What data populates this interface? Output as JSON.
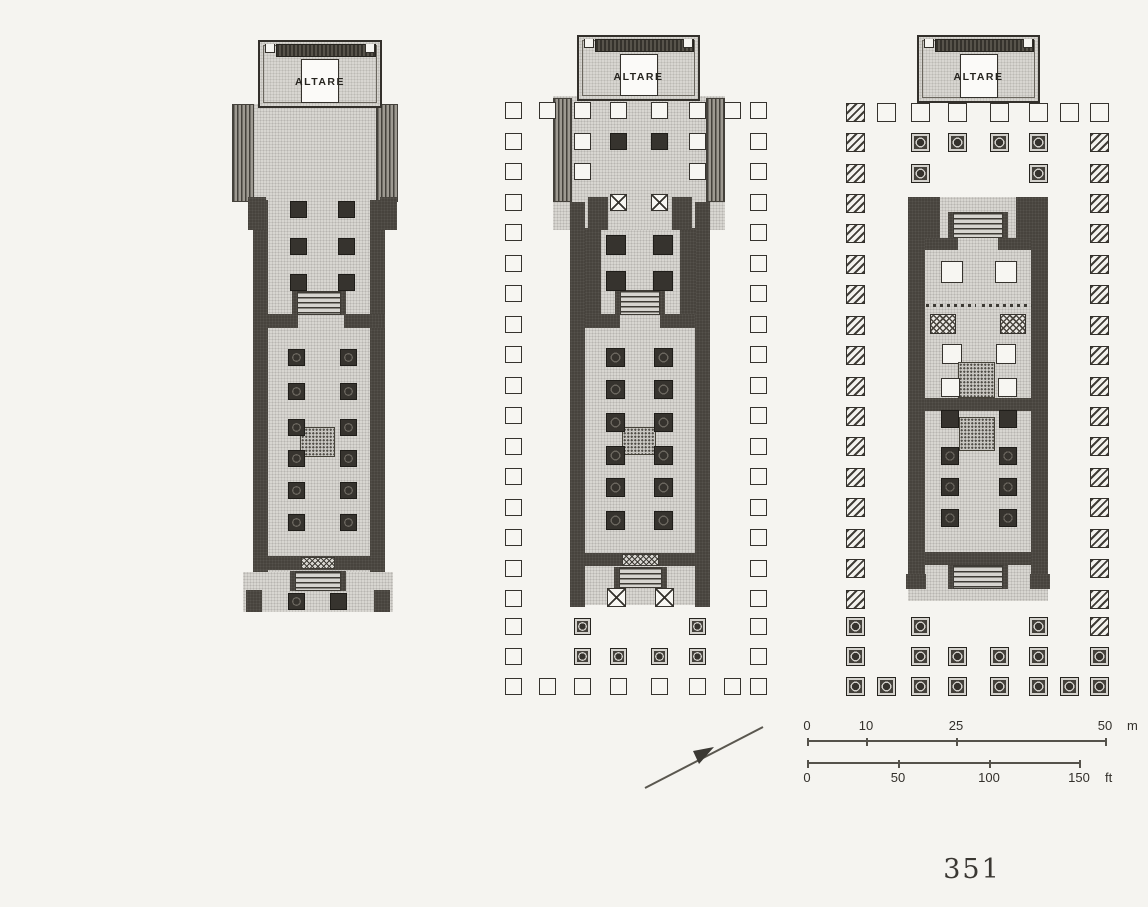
{
  "page": {
    "number": "351"
  },
  "labels": {
    "altar": "ALTARE"
  },
  "colors": {
    "paper": "#f5f4f0",
    "ink": "#33302b",
    "wall": "#47433d",
    "floor": "#d8d6d1"
  },
  "north_arrow": {
    "line": {
      "x1": 645,
      "y1": 788,
      "x2": 763,
      "y2": 727
    },
    "head_points": "714,747 693,751 699,764"
  },
  "scale_bar": {
    "meters": {
      "y": 740,
      "x_start": 807,
      "x_end": 1105,
      "unit": "m",
      "labels_above": true,
      "ticks": [
        [
          "0",
          807
        ],
        [
          "10",
          866
        ],
        [
          "25",
          956
        ],
        [
          "50",
          1105
        ]
      ]
    },
    "feet": {
      "y": 762,
      "x_start": 807,
      "x_end": 1079,
      "unit": "ft",
      "labels_above": false,
      "ticks": [
        [
          "0",
          807
        ],
        [
          "50",
          898
        ],
        [
          "100",
          989
        ],
        [
          "150",
          1079
        ]
      ]
    }
  },
  "plans": [
    {
      "id": "temple-plan-1",
      "altar": {
        "x": 258,
        "y": 40,
        "w": 124,
        "h": 68
      },
      "peristyle": null,
      "elements": [
        [
          "floor",
          232,
          104,
          166,
          98
        ],
        [
          "hatchv",
          232,
          104,
          22,
          98
        ],
        [
          "hatchv",
          376,
          104,
          22,
          98
        ],
        [
          "floor",
          253,
          200,
          132,
          372
        ],
        [
          "floor",
          243,
          572,
          150,
          40
        ],
        [
          "wall",
          253,
          200,
          15,
          372
        ],
        [
          "wall",
          370,
          200,
          15,
          372
        ],
        [
          "wall",
          253,
          556,
          132,
          14
        ],
        [
          "wall",
          253,
          314,
          45,
          14
        ],
        [
          "wall",
          344,
          314,
          41,
          14
        ],
        [
          "wall",
          248,
          197,
          18,
          33
        ],
        [
          "wall",
          380,
          197,
          17,
          33
        ],
        [
          "steps",
          297,
          291,
          44,
          24
        ],
        [
          "wall",
          292,
          291,
          5,
          24
        ],
        [
          "wall",
          341,
          291,
          5,
          24
        ],
        [
          "colD",
          290,
          201,
          17,
          17
        ],
        [
          "colD",
          338,
          201,
          17,
          17
        ],
        [
          "colD",
          290,
          238,
          17,
          17
        ],
        [
          "colD",
          338,
          238,
          17,
          17
        ],
        [
          "colD",
          290,
          274,
          17,
          17
        ],
        [
          "colD",
          338,
          274,
          17,
          17
        ],
        [
          "hearth",
          300,
          427,
          35,
          30
        ],
        [
          "colDC",
          288,
          349,
          17,
          17
        ],
        [
          "colDC",
          340,
          349,
          17,
          17
        ],
        [
          "colDC",
          288,
          383,
          17,
          17
        ],
        [
          "colDC",
          340,
          383,
          17,
          17
        ],
        [
          "colDC",
          288,
          419,
          17,
          17
        ],
        [
          "colDC",
          340,
          419,
          17,
          17
        ],
        [
          "colDC",
          288,
          450,
          17,
          17
        ],
        [
          "colDC",
          340,
          450,
          17,
          17
        ],
        [
          "colDC",
          288,
          482,
          17,
          17
        ],
        [
          "colDC",
          340,
          482,
          17,
          17
        ],
        [
          "colDC",
          288,
          514,
          17,
          17
        ],
        [
          "colDC",
          340,
          514,
          17,
          17
        ],
        [
          "xband",
          301,
          557,
          34,
          12
        ],
        [
          "steps",
          295,
          571,
          46,
          20
        ],
        [
          "wall",
          290,
          571,
          5,
          20
        ],
        [
          "wall",
          341,
          571,
          5,
          20
        ],
        [
          "wall",
          246,
          590,
          16,
          22
        ],
        [
          "wall",
          374,
          590,
          16,
          22
        ],
        [
          "colDC",
          288,
          593,
          17,
          17
        ],
        [
          "colD",
          330,
          593,
          17,
          17
        ]
      ]
    },
    {
      "id": "temple-plan-2",
      "altar": {
        "x": 577,
        "y": 35,
        "w": 123,
        "h": 66
      },
      "peristyle": {
        "cols": [
          505,
          539,
          574,
          610,
          651,
          689,
          724,
          750
        ],
        "rows": [
          102,
          133,
          163,
          194,
          224,
          255,
          285,
          316,
          346,
          377,
          407,
          438,
          468,
          499,
          529,
          560,
          590,
          618,
          648,
          678
        ],
        "size": 17,
        "cells": [
          "OOOOOOOO",
          "O.ODDO.O",
          "O.O..O.O",
          "O..XX..O",
          "O......O",
          "O......O",
          "O......O",
          "O......O",
          "O......O",
          "O......O",
          "O......O",
          "O......O",
          "O......O",
          "O......O",
          "O......O",
          "O......O",
          "O......O",
          "O.C..C.O",
          "O.CCCC.O",
          "OOOOOOOO"
        ]
      },
      "elements": [
        [
          "floor",
          553,
          96,
          172,
          134
        ],
        [
          "hatchv",
          553,
          98,
          19,
          104
        ],
        [
          "hatchv",
          706,
          98,
          19,
          104
        ],
        [
          "floor",
          570,
          230,
          140,
          330
        ],
        [
          "floor",
          580,
          560,
          120,
          45
        ],
        [
          "wall",
          570,
          202,
          15,
          405
        ],
        [
          "wall",
          695,
          202,
          15,
          405
        ],
        [
          "wall",
          585,
          228,
          16,
          86
        ],
        [
          "wall",
          680,
          228,
          16,
          86
        ],
        [
          "wall",
          588,
          197,
          20,
          33
        ],
        [
          "wall",
          672,
          197,
          20,
          33
        ],
        [
          "wall",
          585,
          553,
          110,
          13
        ],
        [
          "wall",
          585,
          314,
          35,
          14
        ],
        [
          "wall",
          660,
          314,
          35,
          14
        ],
        [
          "steps",
          620,
          290,
          40,
          25
        ],
        [
          "wall",
          615,
          290,
          5,
          25
        ],
        [
          "wall",
          660,
          290,
          5,
          25
        ],
        [
          "colD",
          606,
          235,
          20,
          20
        ],
        [
          "colD",
          653,
          235,
          20,
          20
        ],
        [
          "colD",
          606,
          271,
          20,
          20
        ],
        [
          "colD",
          653,
          271,
          20,
          20
        ],
        [
          "hearth",
          622,
          427,
          34,
          28
        ],
        [
          "colDC",
          606,
          348,
          19,
          19
        ],
        [
          "colDC",
          654,
          348,
          19,
          19
        ],
        [
          "colDC",
          606,
          380,
          19,
          19
        ],
        [
          "colDC",
          654,
          380,
          19,
          19
        ],
        [
          "colDC",
          606,
          413,
          19,
          19
        ],
        [
          "colDC",
          654,
          413,
          19,
          19
        ],
        [
          "colDC",
          606,
          446,
          19,
          19
        ],
        [
          "colDC",
          654,
          446,
          19,
          19
        ],
        [
          "colDC",
          606,
          478,
          19,
          19
        ],
        [
          "colDC",
          654,
          478,
          19,
          19
        ],
        [
          "colDC",
          606,
          511,
          19,
          19
        ],
        [
          "colDC",
          654,
          511,
          19,
          19
        ],
        [
          "xband",
          622,
          554,
          37,
          12
        ],
        [
          "steps",
          619,
          567,
          43,
          21
        ],
        [
          "wall",
          614,
          567,
          5,
          21
        ],
        [
          "wall",
          662,
          567,
          5,
          21
        ],
        [
          "colX",
          607,
          588,
          19,
          19
        ],
        [
          "colX",
          655,
          588,
          19,
          19
        ]
      ]
    },
    {
      "id": "temple-plan-3",
      "altar": {
        "x": 917,
        "y": 35,
        "w": 123,
        "h": 68
      },
      "peristyle": {
        "cols": [
          846,
          877,
          911,
          948,
          990,
          1029,
          1060,
          1090
        ],
        "rows": [
          103,
          133,
          164,
          194,
          224,
          255,
          285,
          316,
          346,
          377,
          407,
          437,
          468,
          498,
          529,
          559,
          590,
          617,
          647,
          677
        ],
        "size": 19,
        "cells": [
          "HOOOOOOO",
          "H.CCCC.H",
          "H.C..C.H",
          "H......H",
          "H......H",
          "H......H",
          "H......H",
          "H......H",
          "H......H",
          "H......H",
          "H......H",
          "H......H",
          "H......H",
          "H......H",
          "H......H",
          "H......H",
          "H......H",
          "C.C..C.H",
          "C.CCCC.C",
          "CCCCCCCC"
        ]
      },
      "elements": [
        [
          "floor",
          908,
          197,
          140,
          390
        ],
        [
          "floor",
          908,
          553,
          140,
          48
        ],
        [
          "wall",
          908,
          197,
          17,
          390
        ],
        [
          "wall",
          1031,
          197,
          17,
          390
        ],
        [
          "wall",
          908,
          197,
          32,
          42
        ],
        [
          "wall",
          1016,
          197,
          32,
          42
        ],
        [
          "steps",
          953,
          212,
          50,
          26
        ],
        [
          "wall",
          948,
          212,
          5,
          26
        ],
        [
          "wall",
          1003,
          212,
          5,
          26
        ],
        [
          "wall",
          925,
          238,
          33,
          12
        ],
        [
          "wall",
          998,
          238,
          33,
          12
        ],
        [
          "colO",
          941,
          261,
          22,
          22
        ],
        [
          "colO",
          995,
          261,
          22,
          22
        ],
        [
          "dots",
          926,
          304,
          50,
          3
        ],
        [
          "dots",
          982,
          304,
          50,
          3
        ],
        [
          "colXh",
          930,
          314,
          26,
          20
        ],
        [
          "colXh",
          1000,
          314,
          26,
          20
        ],
        [
          "colO",
          942,
          344,
          20,
          20
        ],
        [
          "colO",
          996,
          344,
          20,
          20
        ],
        [
          "hearth",
          958,
          362,
          37,
          36
        ],
        [
          "colO",
          941,
          378,
          19,
          19
        ],
        [
          "colO",
          998,
          378,
          19,
          19
        ],
        [
          "wall",
          925,
          398,
          106,
          13
        ],
        [
          "colD",
          941,
          410,
          18,
          18
        ],
        [
          "colD",
          999,
          410,
          18,
          18
        ],
        [
          "hearth",
          959,
          417,
          36,
          34
        ],
        [
          "colDC",
          941,
          447,
          18,
          18
        ],
        [
          "colDC",
          999,
          447,
          18,
          18
        ],
        [
          "colDC",
          941,
          478,
          18,
          18
        ],
        [
          "colDC",
          999,
          478,
          18,
          18
        ],
        [
          "colDC",
          941,
          509,
          18,
          18
        ],
        [
          "colDC",
          999,
          509,
          18,
          18
        ],
        [
          "wall",
          925,
          552,
          106,
          13
        ],
        [
          "steps",
          953,
          565,
          50,
          24
        ],
        [
          "wall",
          948,
          565,
          5,
          24
        ],
        [
          "wall",
          1003,
          565,
          5,
          24
        ],
        [
          "wall",
          906,
          574,
          20,
          15
        ],
        [
          "wall",
          1030,
          574,
          20,
          15
        ]
      ]
    }
  ]
}
